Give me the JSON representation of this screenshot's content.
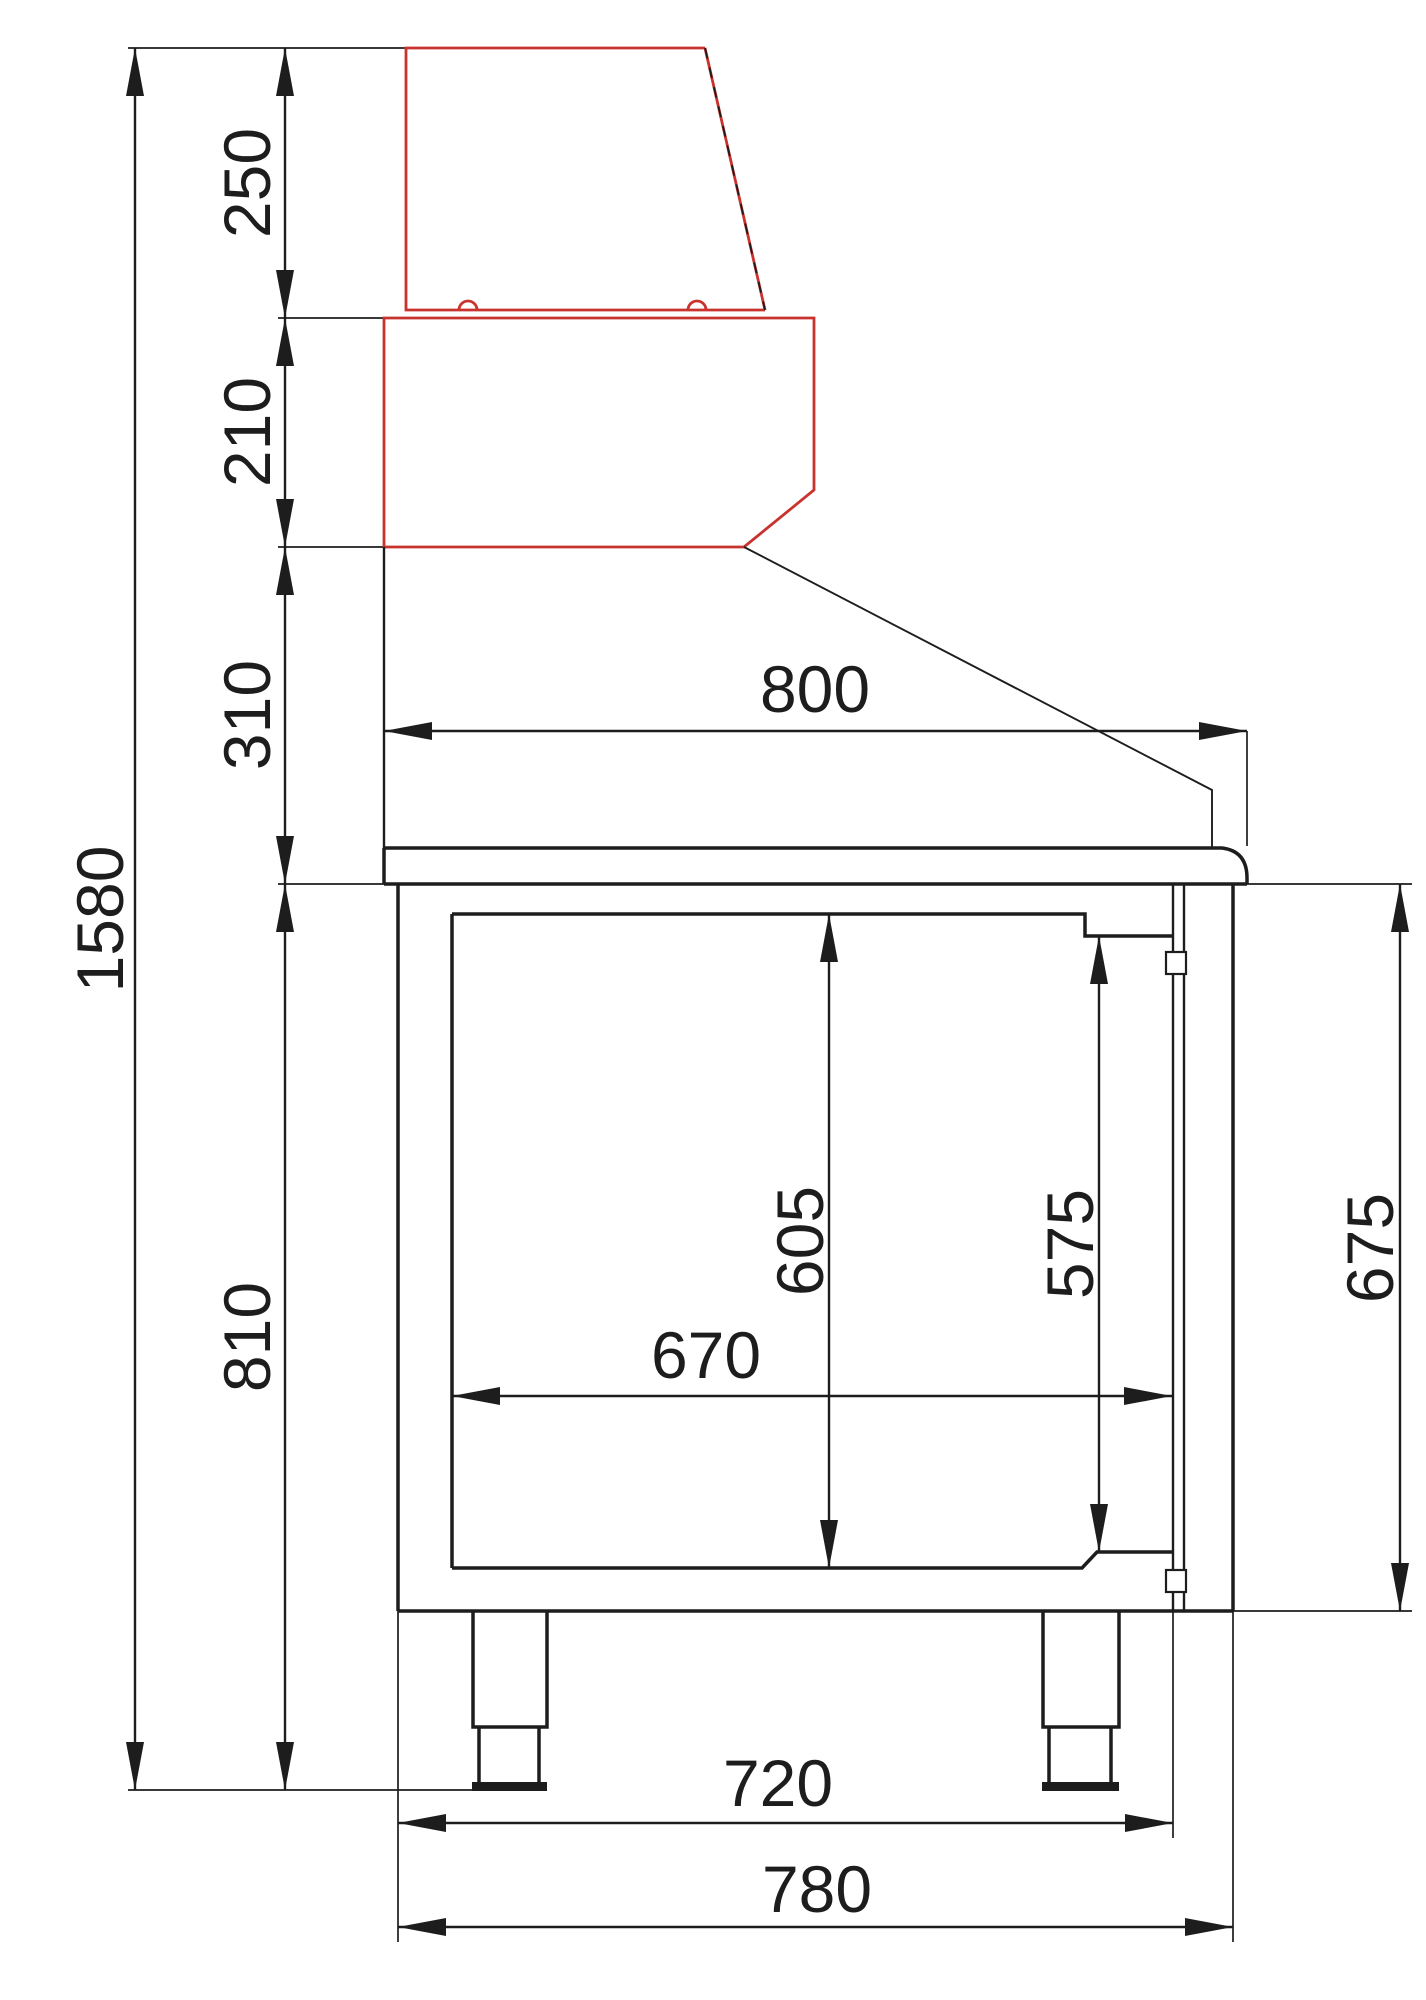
{
  "meta": {
    "type": "technical-dimension-drawing",
    "view": "side-section",
    "subject": "refrigerated saladette counter with display hood",
    "units": "mm",
    "canvas": {
      "width": 1426,
      "height": 2000
    }
  },
  "colors": {
    "ink": "#1d1d1d",
    "red": "#c9332e",
    "bg": "#ffffff"
  },
  "dims": {
    "overall_height": "1580",
    "hood_height": "250",
    "pan_rail_height": "210",
    "splashback_height": "310",
    "body_height": "810",
    "worktop_depth": "800",
    "interior_height_rear": "605",
    "interior_height_front": "575",
    "door_height": "675",
    "interior_depth": "670",
    "base_depth": "720",
    "overall_depth": "780"
  }
}
